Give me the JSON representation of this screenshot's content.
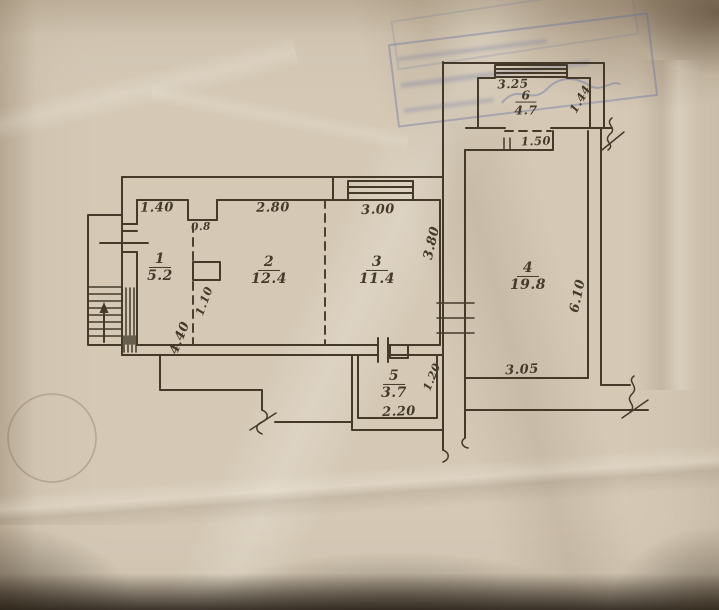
{
  "rooms": [
    {
      "number": "1",
      "area": "5.2"
    },
    {
      "number": "2",
      "area": "12.4"
    },
    {
      "number": "3",
      "area": "11.4"
    },
    {
      "number": "4",
      "area": "19.8"
    },
    {
      "number": "5",
      "area": "3.7"
    },
    {
      "number": "6",
      "area": "4.7"
    }
  ],
  "dims": {
    "room1_width": "1.40",
    "room2_width": "2.80",
    "room3_width": "3.00",
    "niche_width": "0.8",
    "room3_depth": "3.80",
    "partition_length": "1.10",
    "left_block_depth": "4.40",
    "room5_width": "2.20",
    "corridor_width": "1.20",
    "room4_width": "3.05",
    "room4_depth": "6.10",
    "opening_width": "1.50",
    "room6_width": "3.25",
    "room6_depth": "1.44"
  },
  "colors": {
    "ink": "#453a2a",
    "paper": "#d5c9b6",
    "stamp": "#5f6c9e"
  }
}
